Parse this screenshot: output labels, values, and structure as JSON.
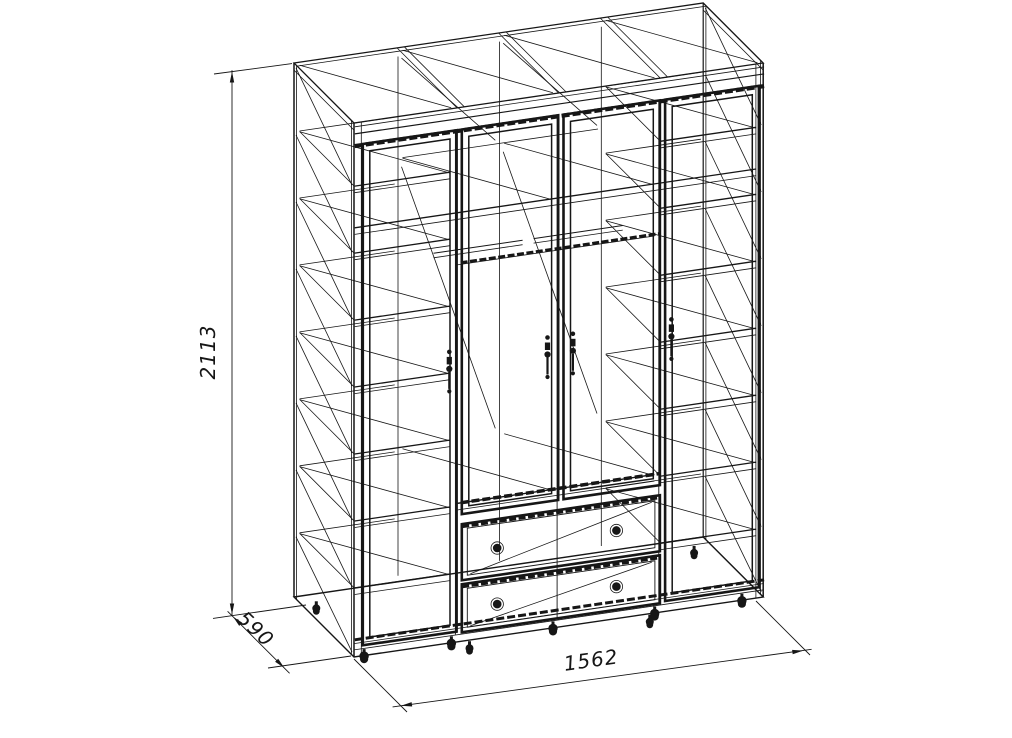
{
  "drawing": {
    "background": "#ffffff",
    "line_color": "#161616"
  },
  "dimension_labels": {
    "height": "2113",
    "depth": "590",
    "width": "1562"
  }
}
